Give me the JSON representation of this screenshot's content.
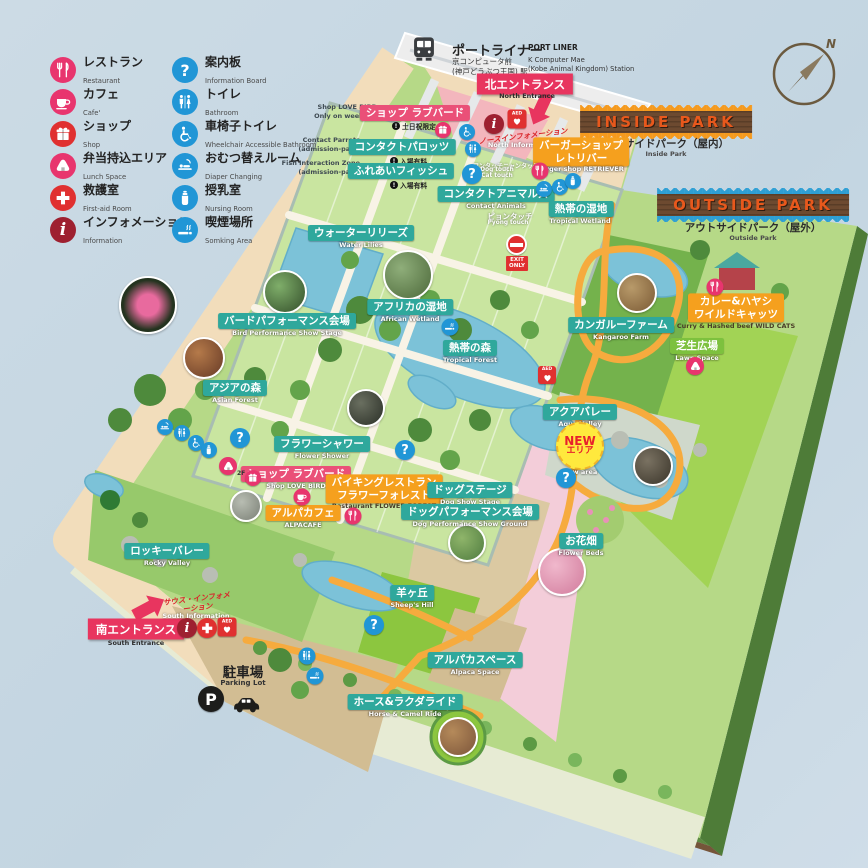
{
  "title": "Kobe Animal Kingdom Park Map",
  "legend": {
    "items": [
      {
        "jp": "レストラン",
        "en": "Restaurant",
        "icon": "restaurant-icon"
      },
      {
        "jp": "カフェ",
        "en": "Cafe'",
        "icon": "cafe-icon"
      },
      {
        "jp": "ショップ",
        "en": "Shop",
        "icon": "shop-icon"
      },
      {
        "jp": "弁当持込エリア",
        "en": "Lunch Space",
        "icon": "lunch-icon"
      },
      {
        "jp": "救護室",
        "en": "First-aid Room",
        "icon": "first-aid-icon"
      },
      {
        "jp": "インフォメーション",
        "en": "Information",
        "icon": "information-icon"
      },
      {
        "jp": "案内板",
        "en": "Information Board",
        "icon": "question-icon"
      },
      {
        "jp": "トイレ",
        "en": "Bathroom",
        "icon": "toilet-icon"
      },
      {
        "jp": "車椅子トイレ",
        "en": "Wheelchair Accessible Bathroom",
        "icon": "wheelchair-icon"
      },
      {
        "jp": "おむつ替えルーム",
        "en": "Diaper Changing",
        "icon": "diaper-icon"
      },
      {
        "jp": "授乳室",
        "en": "Nursing Room",
        "icon": "nursing-icon"
      },
      {
        "jp": "喫煙場所",
        "en": "Somking Area",
        "icon": "smoking-icon"
      }
    ]
  },
  "station": {
    "line_jp": "ポートライナー",
    "station_jp1": "京コンピュータ前",
    "station_jp2": "(神戸どうぶつ王国) 駅",
    "line_en": "PORT LINER",
    "station_en1": "K Computer Mae",
    "station_en2": "(Kobe Animal Kingdom) Station"
  },
  "entrances": {
    "north": {
      "jp": "北エントランス",
      "en": "North Entrance"
    },
    "south": {
      "jp": "南エントランス",
      "en": "South Entrance"
    },
    "north_info": {
      "jp": "ノースインフォメーション",
      "en": "North Information"
    },
    "south_info": {
      "jp": "サウス・インフォメーション",
      "en": "South Information"
    }
  },
  "banners": {
    "inside": {
      "title": "INSIDE PARK",
      "jp": "インサイドパーク（屋内）",
      "en": "Inside Park"
    },
    "outside": {
      "title": "OUTSIDE PARK",
      "jp": "アウトサイドパーク（屋外）",
      "en": "Outside Park"
    }
  },
  "areas": {
    "shop_love_bird_n": {
      "jp": "ショップ ラブバード",
      "note_jp": "土日祝限定",
      "en1": "Shop LOVE BIRD",
      "en2": "Only on weekend"
    },
    "contact_parrots": {
      "jp": "コンタクトパロッツ",
      "note_jp": "入場有料",
      "en1": "Contact Parrots",
      "en2": "(admission-paid)"
    },
    "fish_interaction": {
      "jp": "ふれあいフィッシュ",
      "note_jp": "入場有料",
      "en1": "Fish Interaction Zone",
      "en2": "(admission-paid)"
    },
    "water_lilies": {
      "jp": "ウォーターリリーズ",
      "en": "Water Lilies"
    },
    "burger_shop": {
      "jp1": "バーガーショップ",
      "jp2": "レトリバー",
      "en": "Burger shop RETRIEVER"
    },
    "contact_animals": {
      "jp": "コンタクトアニマルズ",
      "en": "Contact Animals"
    },
    "dog_cat_touch": {
      "jp": "ワンタッチニャンタッチ",
      "en1": "Dog touch",
      "en2": "Cat touch"
    },
    "pyong_touch": {
      "jp": "ピョンタッチ",
      "en": "Pyong touch"
    },
    "tropical_wetland": {
      "jp": "熱帯の湿地",
      "en": "Tropical Wetland"
    },
    "african_wetland": {
      "jp": "アフリカの湿地",
      "en": "African Wetland"
    },
    "bird_performance": {
      "jp": "バードパフォーマンス会場",
      "en": "Bird Performance Show Stage"
    },
    "tropical_forest": {
      "jp": "熱帯の森",
      "en": "Tropical Forest"
    },
    "asian_forest": {
      "jp": "アジアの森",
      "en": "Asian Forest"
    },
    "flower_shower": {
      "jp": "フラワーシャワー",
      "en": "Flower Shower"
    },
    "shop_love_bird_s": {
      "jp": "ショップ ラブバード",
      "en": "Shop LOVE BIRD"
    },
    "restaurant_flower_forest": {
      "jp1": "バイキングレストラン",
      "jp2": "フラワーフォレスト",
      "en": "Restaurant FLOWER FOREST"
    },
    "alpacafe": {
      "jp": "アルパカフェ",
      "en": "ALPACAFE"
    },
    "rocky_valley": {
      "jp": "ロッキーバレー",
      "en": "Rocky Valley"
    },
    "kangaroo_farm": {
      "jp": "カンガルーファーム",
      "en": "Kangaroo Farm"
    },
    "curry_wild_cats": {
      "jp1": "カレー&ハヤシ",
      "jp2": "ワイルドキャッツ",
      "en": "Curry & Hashed beef WILD CATS"
    },
    "lawn_space": {
      "jp": "芝生広場",
      "en": "Lawn Space"
    },
    "aqua_valley": {
      "jp": "アクアバレー",
      "en": "Aqua Valley"
    },
    "new_area": {
      "line1": "NEW",
      "line2": "エリア",
      "en": "New area"
    },
    "dog_stage": {
      "jp": "ドッグステージ",
      "en": "Dog Show Stage"
    },
    "dog_performance": {
      "jp": "ドッグパフォーマンス会場",
      "en": "Dog Performance Show Ground"
    },
    "flower_beds": {
      "jp": "お花畑",
      "en": "Flower Beds"
    },
    "sheeps_hill": {
      "jp": "羊ヶ丘",
      "en": "Sheep's Hill"
    },
    "alpaca_space": {
      "jp": "アルパカスペース",
      "en": "Alpaca Space"
    },
    "horse_camel_ride": {
      "jp": "ホース&ラクダライド",
      "en": "Horse & Camel Ride"
    }
  },
  "parking": {
    "jp": "駐車場",
    "en": "Parking Lot",
    "p": "P"
  },
  "misc": {
    "exit_only_1": "EXIT",
    "exit_only_2": "ONLY",
    "aed": "AED",
    "second_floor": "2F",
    "compass_n": "N",
    "question": "?",
    "info": "i",
    "first_aid_plus": "+",
    "note_mark": "!"
  },
  "colors": {
    "background": "#c9d9e3",
    "park_green": "#b6d987",
    "greenhouse": "#c9e5a0",
    "teal_label": "#2fa89c",
    "pink_label": "#ea5078",
    "orange_label": "#f5a01e",
    "green_label": "#7dc13e",
    "entrance_red": "#e8355f",
    "wood_banner": "#6d4a30",
    "banner_text": "#e8581c",
    "zigzag_inside": "#f59a1e",
    "zigzag_outside": "#2e9fd4",
    "water": "#7cc2d8",
    "blue_icon": "#2196d6",
    "pink_icon": "#e8356e",
    "dark_red_icon": "#9e2030",
    "aed_red": "#e03030"
  }
}
